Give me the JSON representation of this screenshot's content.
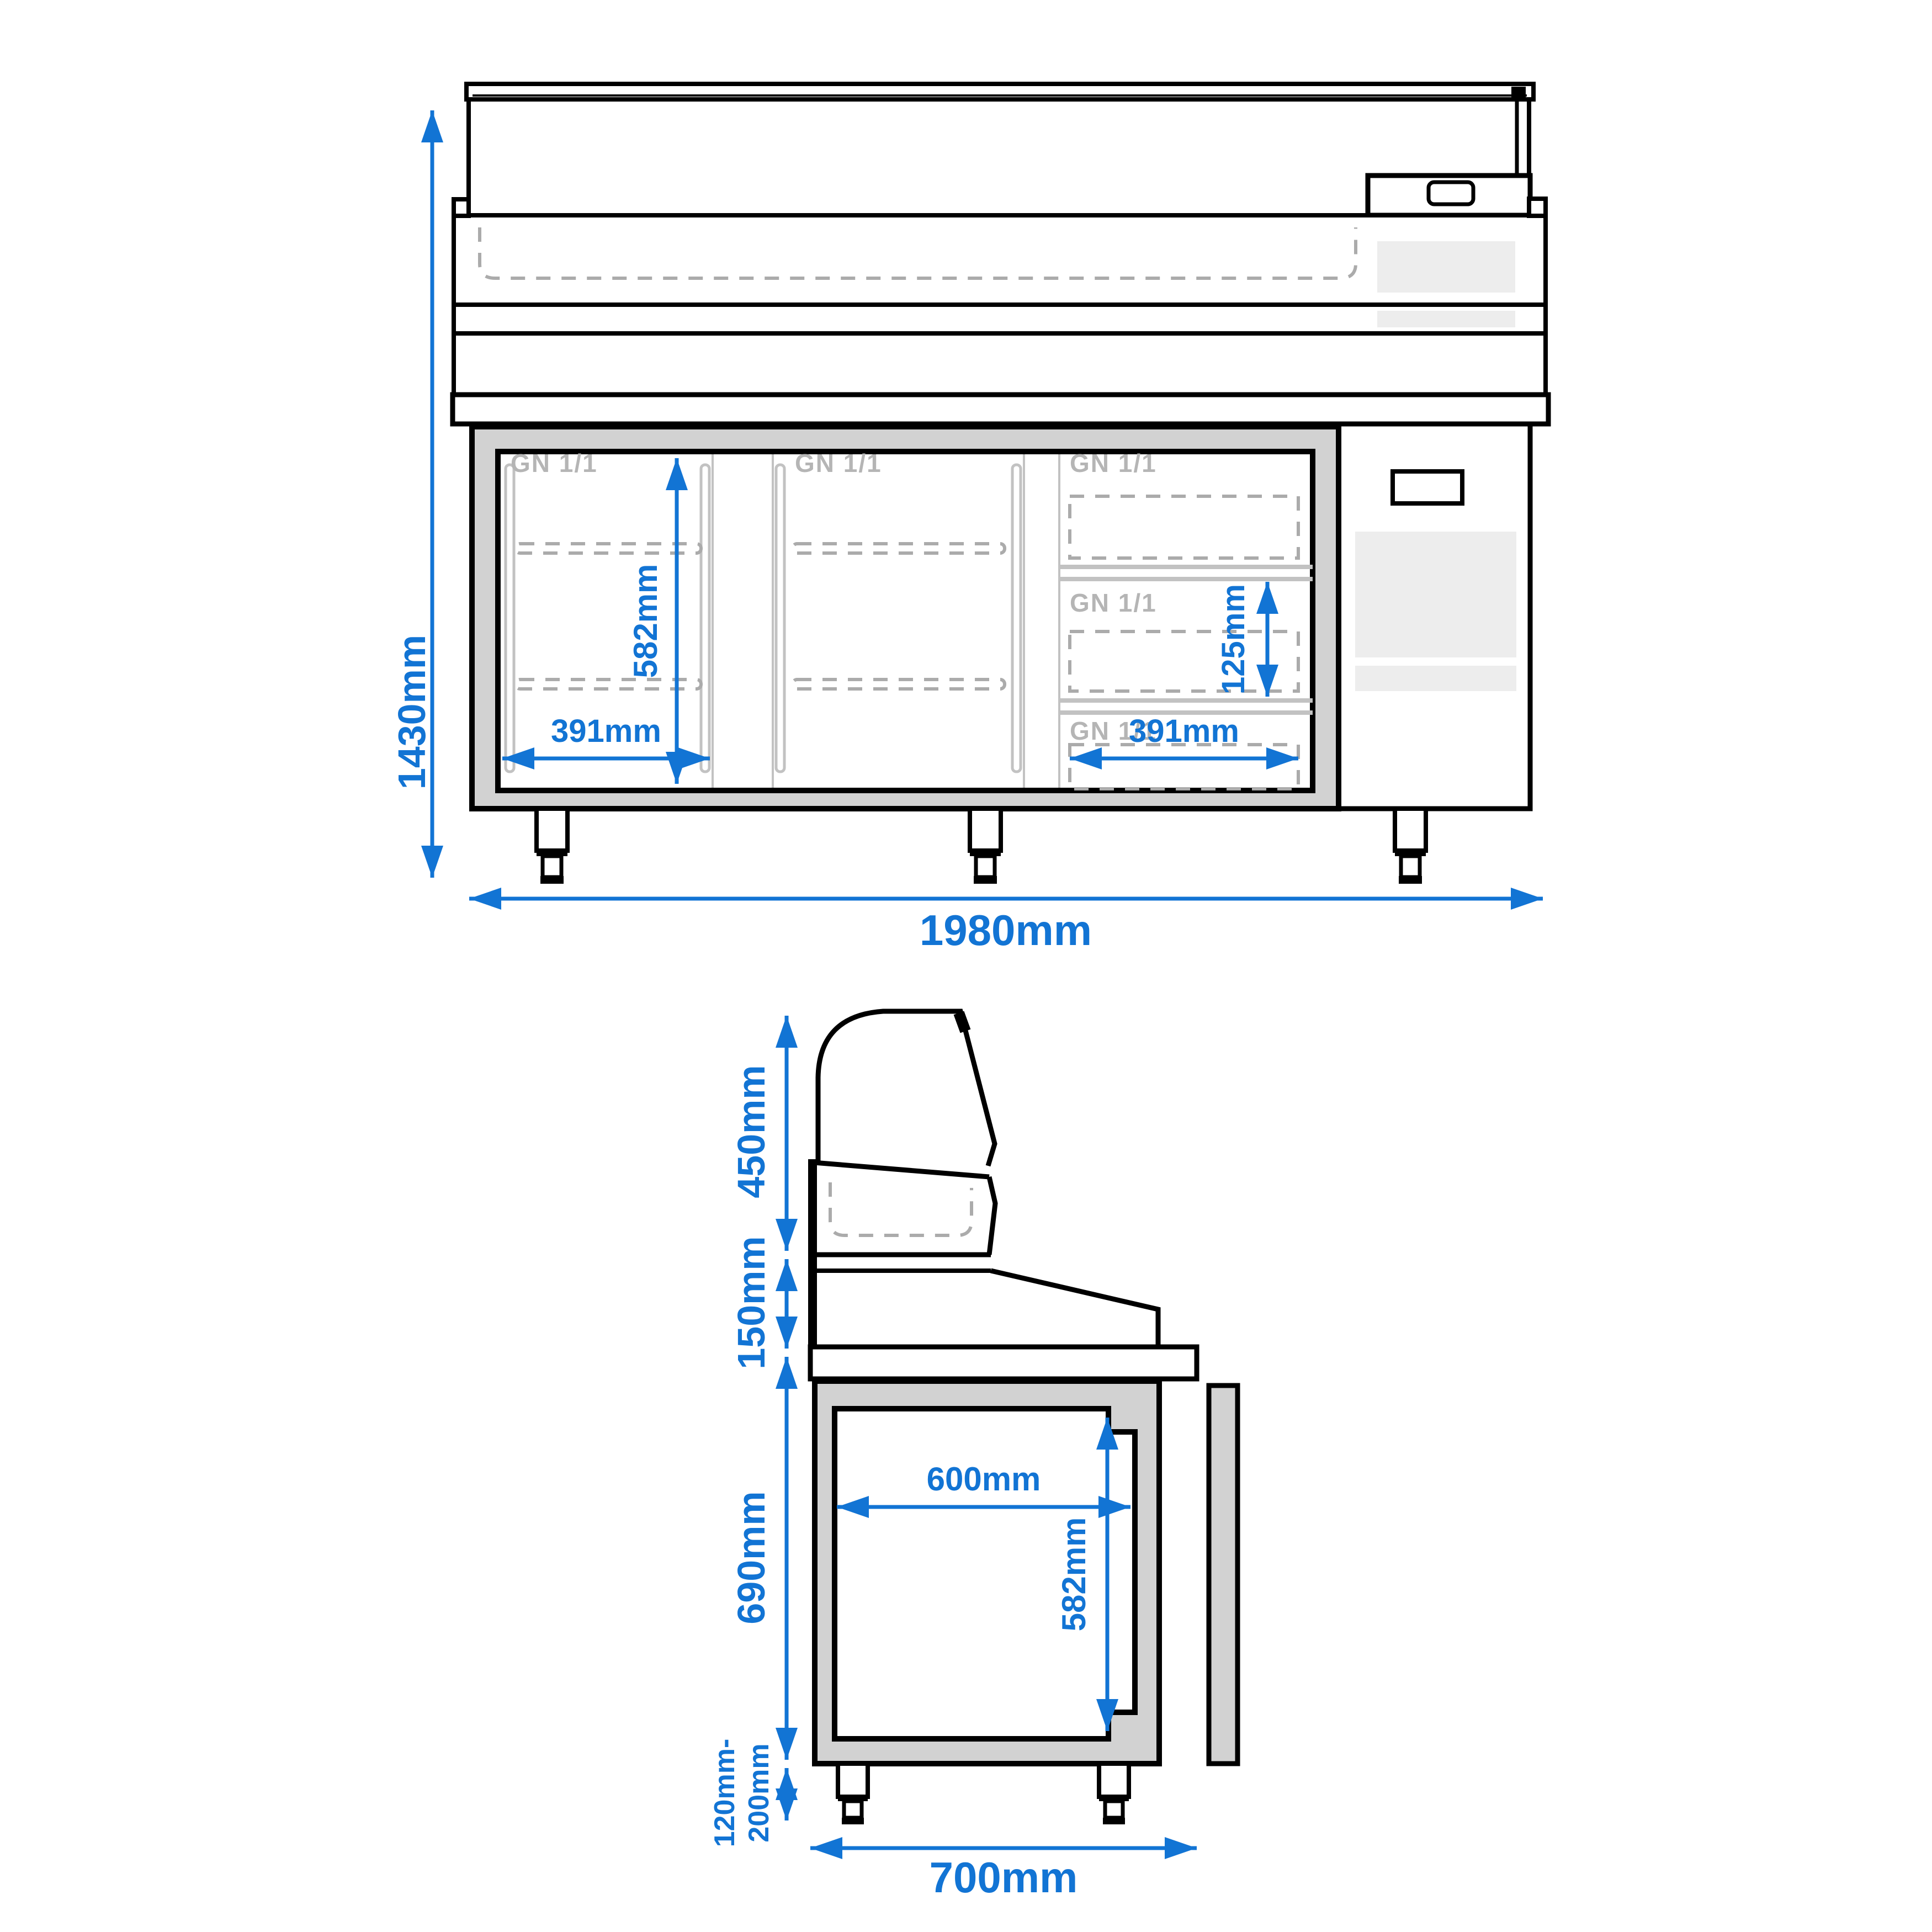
{
  "drawing": {
    "type": "technical-dimension-diagram",
    "subject": "refrigerated prep counter with glass display top",
    "views": [
      "front",
      "side"
    ]
  },
  "front_view": {
    "overall_height": "1430mm",
    "overall_width": "1980mm",
    "compartment_inner_height": "582mm",
    "compartment_width": "391mm",
    "drawer_pan_height": "125mm",
    "drawer_width": "391mm",
    "gn_label": "GN 1/1"
  },
  "side_view": {
    "display_height": "450mm",
    "worktop_band_height": "150mm",
    "body_height": "690mm",
    "foot_height_range_line1": "120mm-",
    "foot_height_range_line2": "200mm",
    "overall_depth": "700mm",
    "inner_depth": "600mm",
    "inner_height": "582mm"
  },
  "colors": {
    "dimension_blue": "#1274d4",
    "outline_black": "#000000",
    "frame_gray": "#d2d2d2",
    "insert_gray": "#ededed",
    "label_gray": "#b5b5b5",
    "dash_gray": "#ababab"
  }
}
